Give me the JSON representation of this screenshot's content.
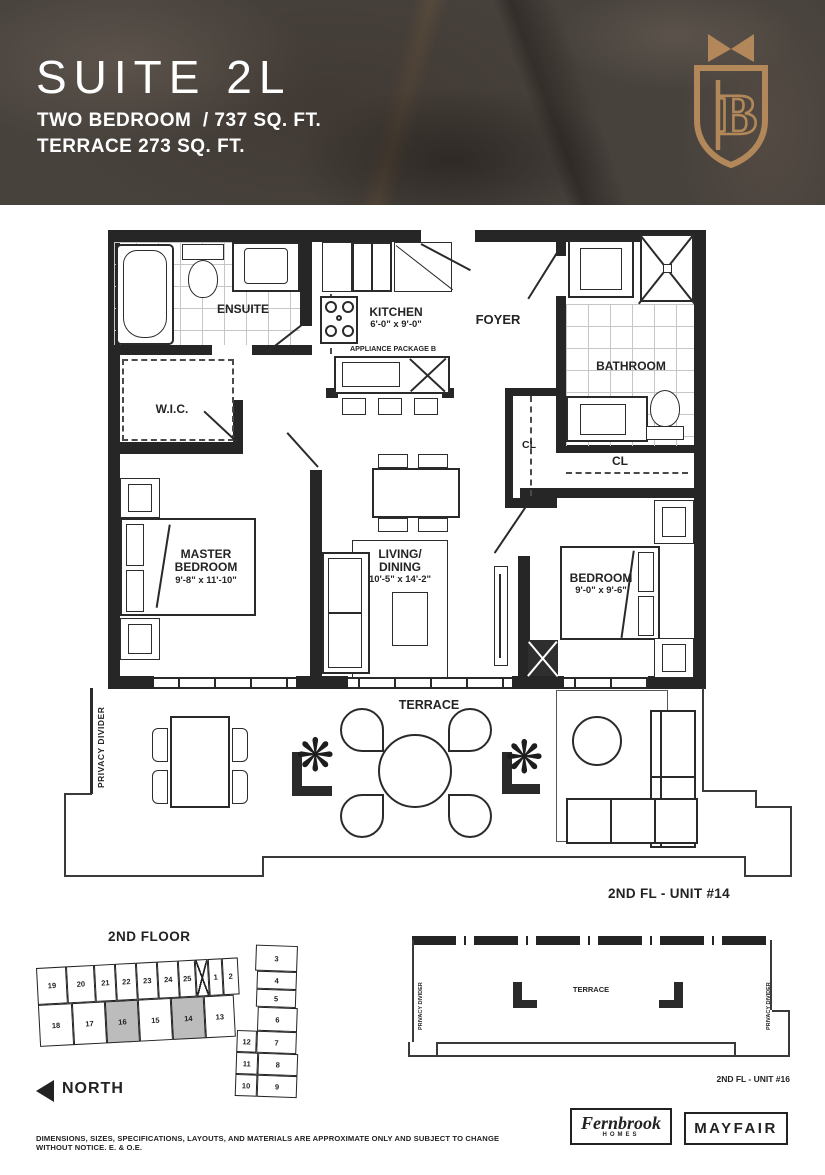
{
  "header": {
    "suite_name": "SUITE 2L",
    "type_line": "TWO BEDROOM  / 737 SQ. FT.",
    "terrace_line": "TERRACE 273 SQ. FT.",
    "logo_letter": "B"
  },
  "colors": {
    "accent_gold": "#b2885a",
    "ink": "#2a2a2a",
    "marble_base": "#48423d",
    "keyplan_highlight": "#bcbcbc"
  },
  "plan": {
    "rooms": {
      "ensuite": "ENSUITE",
      "wic": "W.I.C.",
      "kitchen": "KITCHEN",
      "kitchen_dims": "6'-0\" x 9'-0\"",
      "appliance_note": "APPLIANCE PACKAGE B",
      "foyer": "FOYER",
      "bathroom": "BATHROOM",
      "closet1": "CL",
      "closet2": "CL",
      "master_bedroom": "MASTER BEDROOM",
      "master_dims": "9'-8\" x 11'-10\"",
      "living_line1": "LIVING/",
      "living_line2": "DINING",
      "living_dims": "10'-5\" x 14'-2\"",
      "bedroom": "BEDROOM",
      "bedroom_dims": "9'-0\" x 9'-6\"",
      "terrace": "TERRACE",
      "privacy_divider": "PRIVACY DIVIDER"
    },
    "unit_label": "2ND FL - UNIT #14",
    "plant_glyph": "❋"
  },
  "keyplan": {
    "title": "2ND FLOOR",
    "north": "NORTH",
    "top_row": [
      "19",
      "20",
      "21",
      "22",
      "23",
      "24",
      "25",
      "1",
      "2"
    ],
    "bottom_row": [
      "18",
      "17",
      "16",
      "15",
      "14",
      "13"
    ],
    "wing_outer": [
      "3",
      "4",
      "5",
      "6",
      "7",
      "8",
      "9"
    ],
    "wing_inner": [
      "12",
      "11",
      "10"
    ]
  },
  "terrace_key": {
    "terrace": "TERRACE",
    "privacy_left": "PRIVACY DIVIDER",
    "privacy_right": "PRIVACY DIVIDER",
    "unit_label": "2ND FL - UNIT #16"
  },
  "footer": {
    "disclaimer": "DIMENSIONS, SIZES, SPECIFICATIONS, LAYOUTS, AND MATERIALS ARE APPROXIMATE ONLY AND SUBJECT TO CHANGE WITHOUT NOTICE. E. & O.E.",
    "builder_logo_line1": "Fernbrook",
    "builder_logo_line2": "HOMES",
    "partner_logo": "MAYFAIR"
  }
}
